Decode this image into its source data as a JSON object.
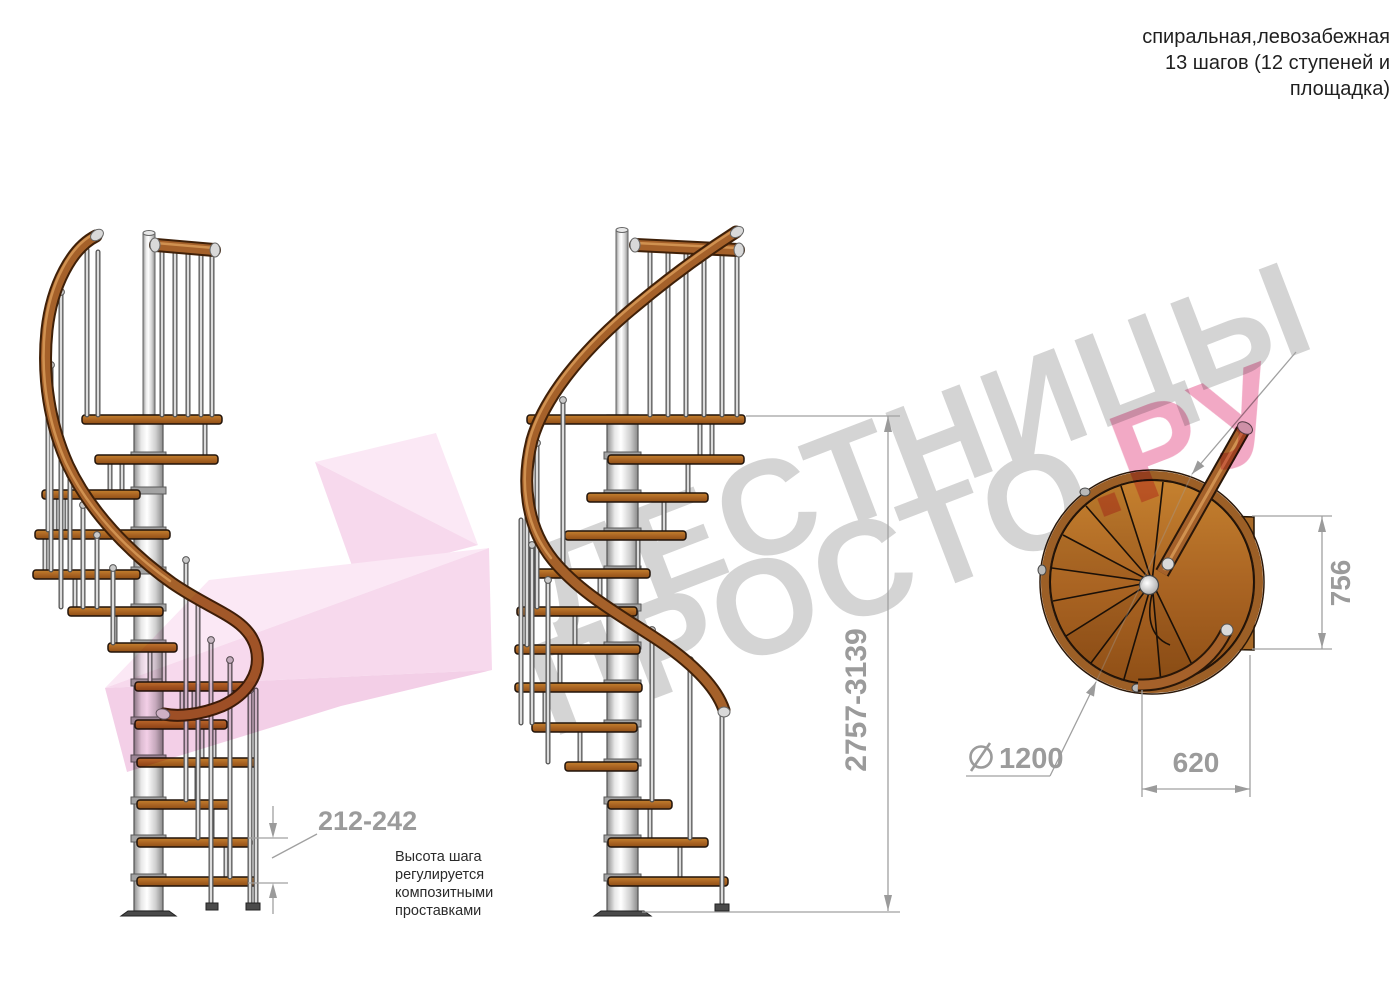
{
  "header": {
    "line1": "спиральная,левозабежная",
    "line2": "13 шагов (12 ступеней и",
    "line3": "площадка)"
  },
  "watermark": {
    "word1": "ЛЕСТНИЦЫ",
    "word2": "ПРОСТО",
    "word3": ".РУ"
  },
  "dimensions": {
    "step_height": "212-242",
    "total_height": "2757-3139",
    "landing_width": "756",
    "landing_depth": "620",
    "diameter_symbol": "⌀",
    "diameter_value": "1200"
  },
  "annotation": {
    "line1": "Высота шага",
    "line2": "регулируется",
    "line3": "композитными",
    "line4": "проставками"
  },
  "colors": {
    "wood": "#b4762f",
    "wood_dark": "#8a4f1b",
    "rail_mid": "#a5612a",
    "rail_dark": "#3f2008",
    "rail_light": "#d09150",
    "metal_light": "#d9d9d9",
    "metal_dark": "#555555",
    "dim_gray": "#9b9b9b",
    "title_text": "#222222",
    "watermark_gray": "#d4d4d4",
    "watermark_pink": "#f2a9c5",
    "logo_pink_light": "#fbe8f5",
    "logo_pink_mid": "#f7d9ed",
    "logo_pink_deep": "#f3cfe7"
  }
}
